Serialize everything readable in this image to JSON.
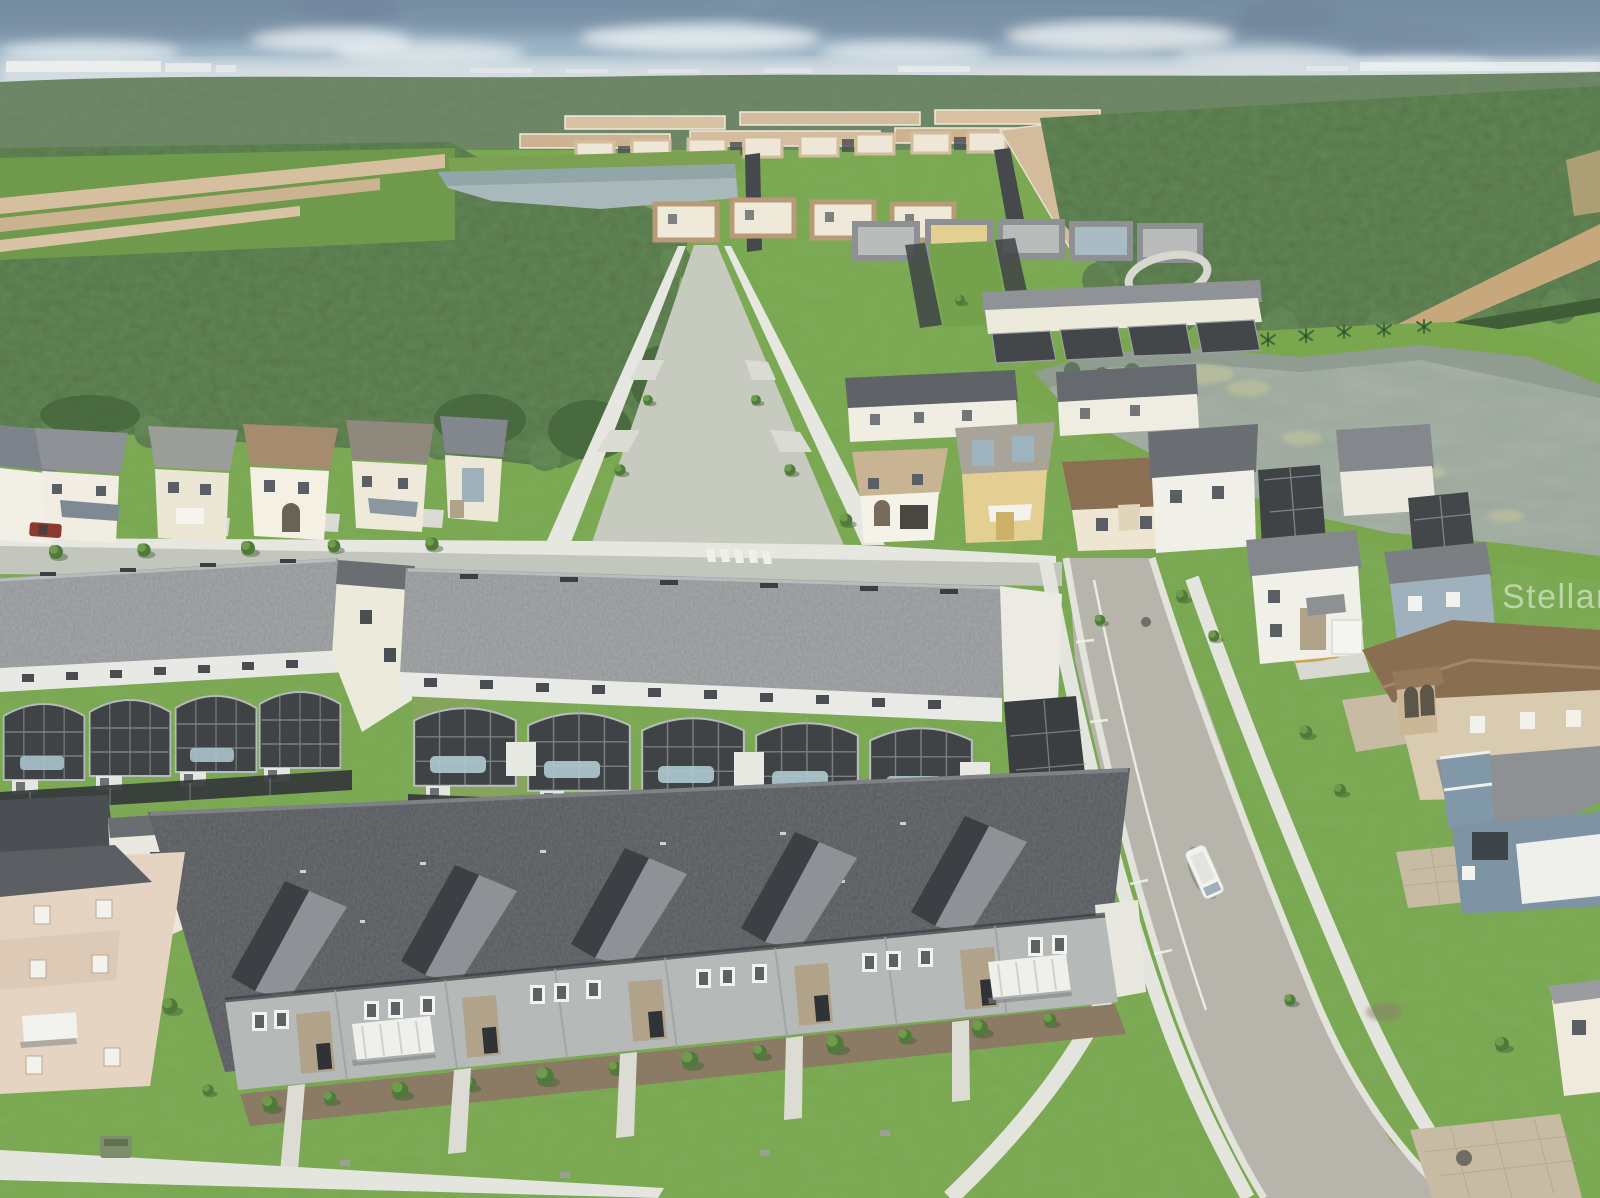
{
  "meta": {
    "type": "aerial-drone-photograph",
    "subject": "Master-planned Florida vacation-home community: rows of townhomes with screened pool enclosures in the foreground, single-family two-story homes along a straight tree-lined street, a retention lake, a tan-roof subdivision with a pond, and conservation forest to the hazy horizon under a partly cloudy sky"
  },
  "watermark": {
    "text": "StellarMLS",
    "color": "#ffffff",
    "opacity": "0.5"
  },
  "palette": {
    "sky_top": "#7e97ad",
    "sky_low": "#c6d4dc",
    "haze": "#dde3e5",
    "cloud": "#edf2f4",
    "storm_cloud": "#6e8399",
    "forest_far": "#6d8267",
    "forest_near": "#567549",
    "canopy_light": "#7fa35c",
    "ground_grass": "#79a750",
    "lawn_bright": "#83b559",
    "pond": "#a9b8ba",
    "lake": "#9aa69a",
    "algae": "#c6c79b",
    "beige_roof": "#d6c0a0",
    "tan_roof": "#a58c6e",
    "brown_roof": "#8a6f52",
    "gray_roof": "#909395",
    "dark_roof": "#54575b",
    "wall_white": "#f1eee5",
    "wall_cream": "#ece4cf",
    "wall_yellow": "#e4cf92",
    "wall_bluegray": "#7e94a4",
    "wall_gray": "#b5b9b7",
    "stone": "#b1a28a",
    "mulch": "#8b7a64",
    "street_concrete": "#c7cabf",
    "asphalt": "#b6b4ab",
    "sidewalk": "#e4e5de",
    "pavers": "#c7bba3",
    "dirt_trail": "#c7a87c",
    "screen_mesh": "#3f4346",
    "pool_water": "#adc8ce",
    "van": "#f2f2ef",
    "car_gold": "#c9a847",
    "truck_red": "#8d3a2e",
    "utility_box": "#7c8f6a"
  },
  "scene": {
    "regions": [
      "sky",
      "storm-cloud-bank",
      "horizon-haze",
      "distant-skyline",
      "far-forest",
      "left-forest",
      "right-forest",
      "tan-roof-subdivision",
      "community-pond",
      "single-family-streetscape",
      "central-street",
      "retention-lake",
      "lakefront-homes",
      "townhome-row-with-pool-cages",
      "foreground-townhome-row",
      "curved-street",
      "garden-strip"
    ],
    "vehicles": [
      {
        "name": "white-van",
        "location": "parked at curb of curved street"
      },
      {
        "name": "gold-hatchback",
        "location": "driveway near street bend"
      },
      {
        "name": "red-pickup",
        "location": "driveway of left house row"
      }
    ]
  }
}
